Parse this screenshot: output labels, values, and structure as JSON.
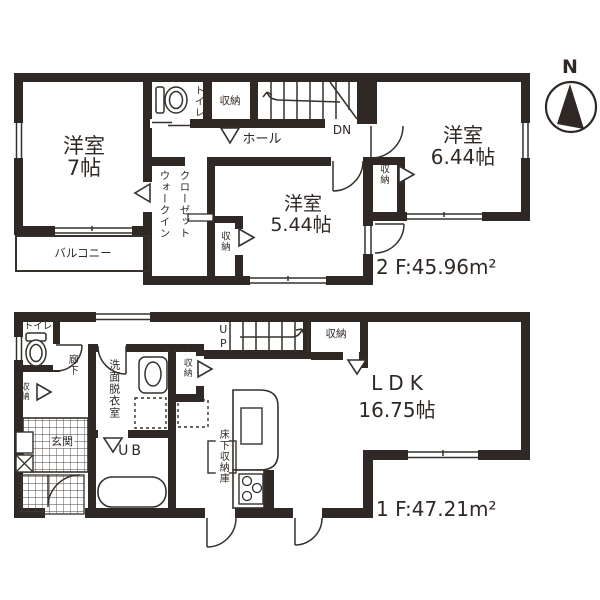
{
  "title": "2-story house floor plan",
  "colors": {
    "wall": "#2f2824",
    "line": "#35302b",
    "hatch": "#4a423c"
  },
  "compass": {
    "north": "N"
  },
  "floor2": {
    "room7": {
      "name": "洋室",
      "size": "7帖"
    },
    "toilet": "トイレ",
    "storage_top": "収納",
    "hall": "ホール",
    "stairs_label": "DN",
    "room644": {
      "name": "洋室",
      "size": "6.44帖"
    },
    "storage_644": "収納",
    "wic_line1": "ウォークイン",
    "wic_line2": "クローゼット",
    "storage_small": "収納",
    "room544": {
      "name": "洋室",
      "size": "5.44帖"
    },
    "balcony": "バルコニー",
    "area_label": "2 F:45.96m²"
  },
  "floor1": {
    "toilet": "トイレ",
    "hallway": "廊下",
    "storage_left": "収納",
    "entrance": "玄関",
    "stairs_label": "UP",
    "storage_stairs": "収納",
    "washroom": "洗面脱衣室",
    "storage_wash": "収納",
    "bath": "UB",
    "underfloor_storage": "床下収納庫",
    "ldk": {
      "name": "LDK",
      "size": "16.75帖"
    },
    "area_label": "1 F:47.21m²"
  }
}
